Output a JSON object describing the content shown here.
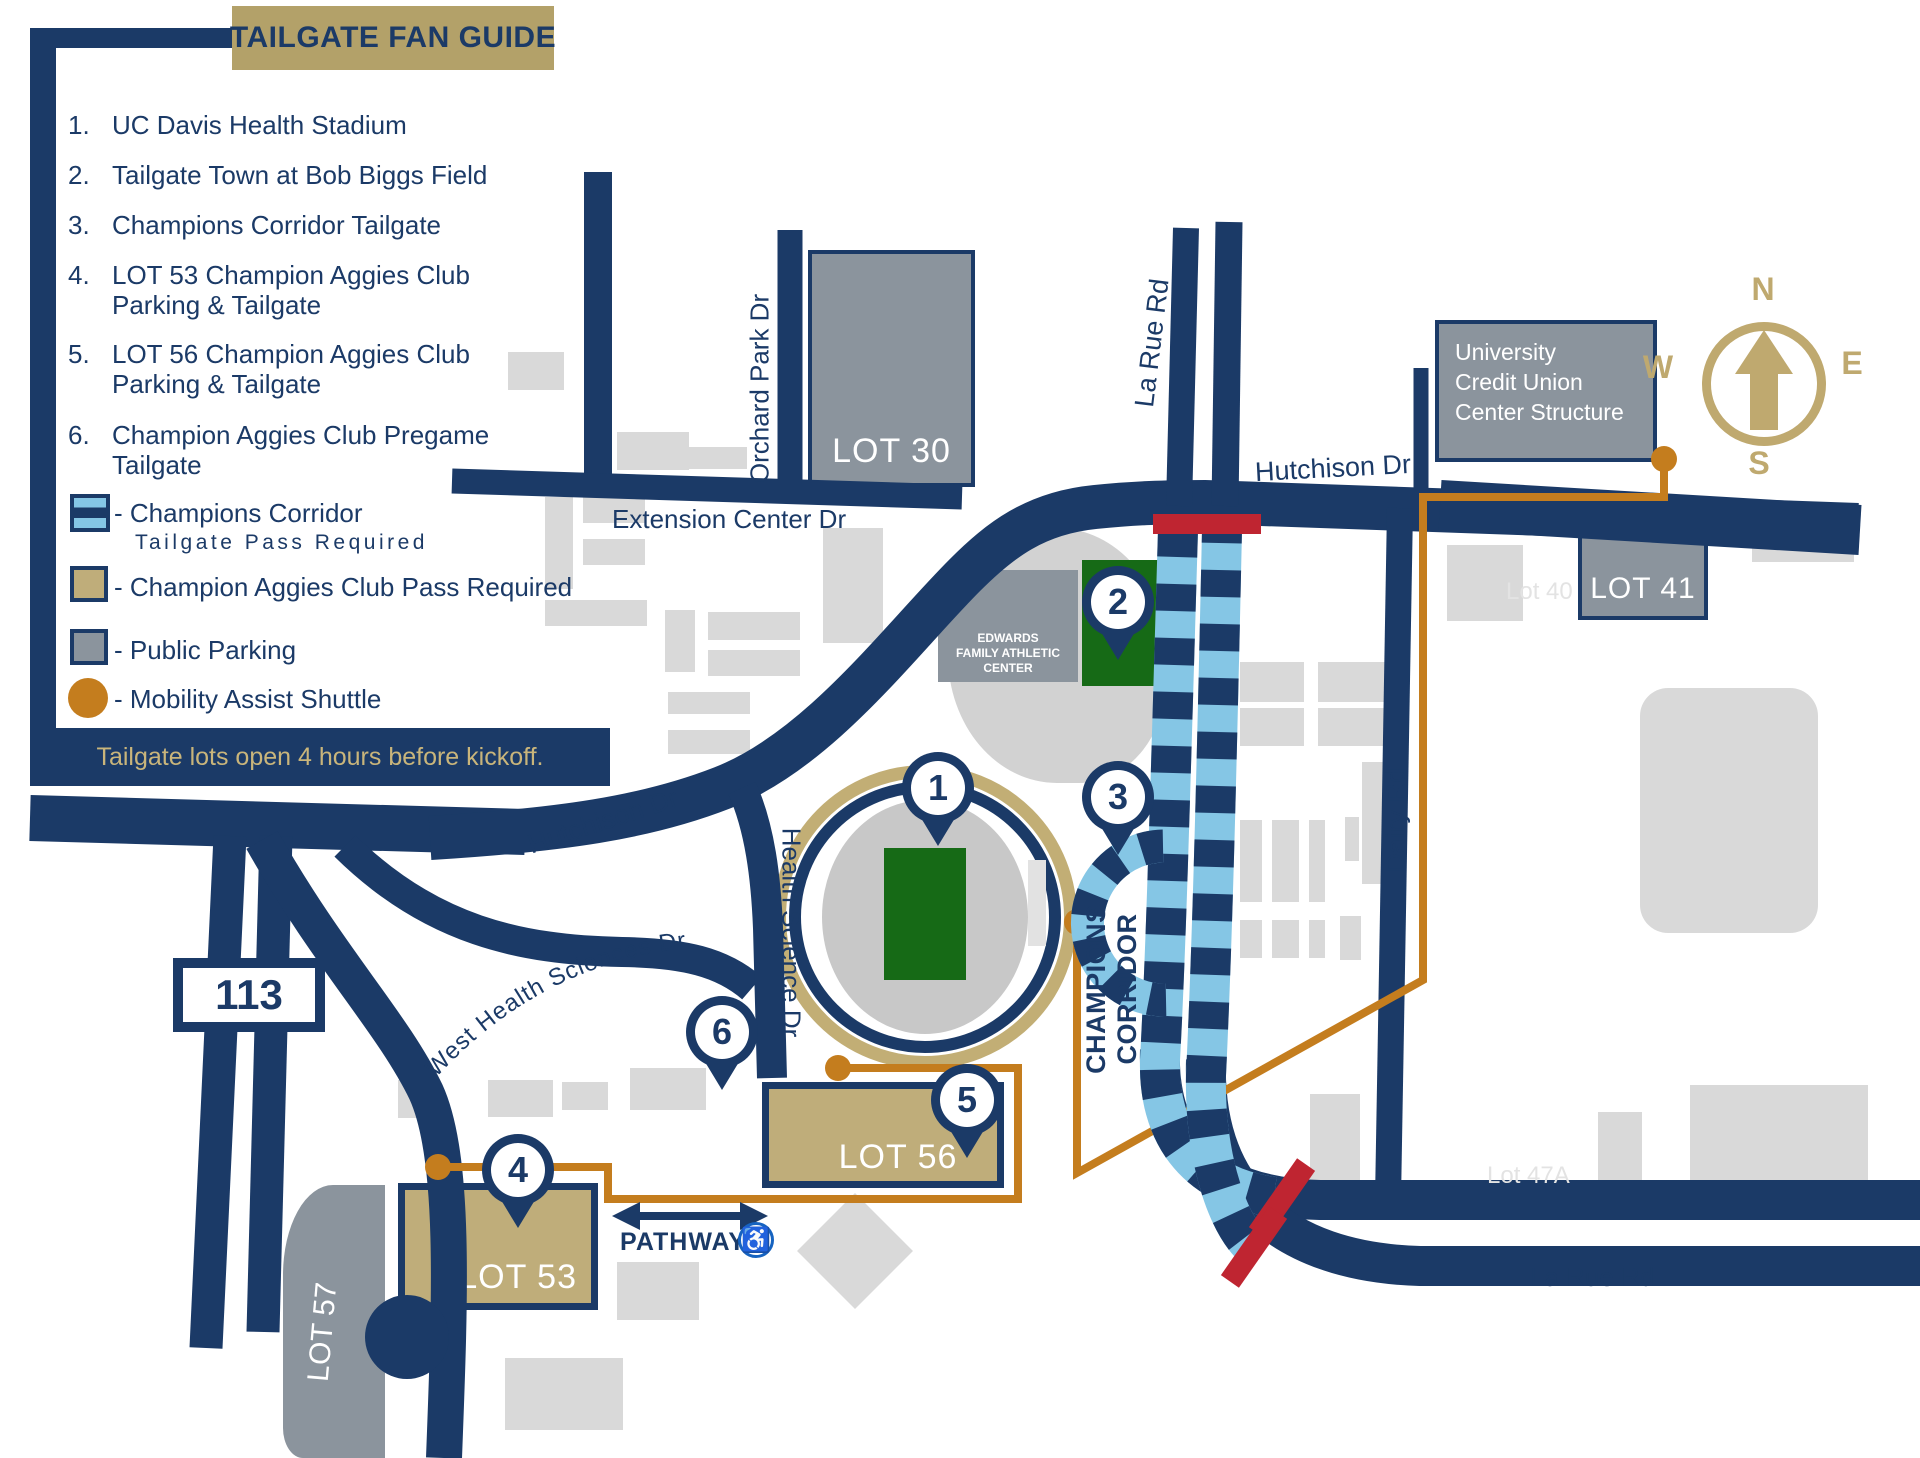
{
  "legend": {
    "title": "TAILGATE FAN GUIDE",
    "items": [
      {
        "num": "1.",
        "label": "UC Davis Health Stadium"
      },
      {
        "num": "2.",
        "label": "Tailgate Town at Bob Biggs Field"
      },
      {
        "num": "3.",
        "label": "Champions Corridor Tailgate"
      },
      {
        "num": "4.",
        "label": "LOT 53 Champion Aggies Club Parking & Tailgate"
      },
      {
        "num": "5.",
        "label": "LOT 56 Champion Aggies Club Parking & Tailgate"
      },
      {
        "num": "6.",
        "label": "Champion Aggies Club Pregame Tailgate"
      }
    ],
    "keys": [
      {
        "label": "- Champions Corridor",
        "sublabel": "Tailgate Pass Required",
        "icon": "champions-corridor-striped-square"
      },
      {
        "label": "- Champion Aggies Club Pass Required",
        "icon": "tan-square"
      },
      {
        "label": "- Public Parking",
        "icon": "gray-square"
      },
      {
        "label": "- Mobility Assist Shuttle",
        "icon": "orange-circle"
      }
    ],
    "note": "Tailgate lots open 4 hours before kickoff."
  },
  "map": {
    "highway_shield": "113",
    "roads": {
      "hutchison": "Hutchison Dr",
      "extension": "Extension Center Dr",
      "orchard": "Orchard Park Dr",
      "larue": "La Rue Rd",
      "dairy": "Dairy Rd",
      "health_science": "Health Science Dr",
      "west_health": "West Health Sciences Dr"
    },
    "lots": {
      "lot30": "LOT 30",
      "lot40": "Lot 40",
      "lot41": "LOT 41",
      "lot47a": "Lot 47A",
      "lot53": "LOT 53",
      "lot56": "LOT 56",
      "lot57": "LOT 57"
    },
    "ucu_lines": [
      "University",
      "Credit Union",
      "Center Structure"
    ],
    "edwards_lines": [
      "EDWARDS",
      "FAMILY ATHLETIC",
      "CENTER"
    ],
    "corridor_lines": [
      "CHAMPIONS",
      "CORRIDOR"
    ],
    "pathway": "PATHWAY",
    "markers": [
      "1",
      "2",
      "3",
      "4",
      "5",
      "6"
    ],
    "compass": {
      "n": "N",
      "e": "E",
      "s": "S",
      "w": "W"
    }
  },
  "icons": {
    "accessibility": "♿"
  },
  "colors": {
    "navy": "#1b3a67",
    "gold": "#b3a169",
    "lot_tan": "#bfad7a",
    "light_blue": "#85c6e5",
    "shuttle_orange": "#c47d1e",
    "closure_red": "#bf2531",
    "parking_gray": "#8b949d",
    "building_gray": "#d9d9d9",
    "field_green": "#166a16"
  }
}
